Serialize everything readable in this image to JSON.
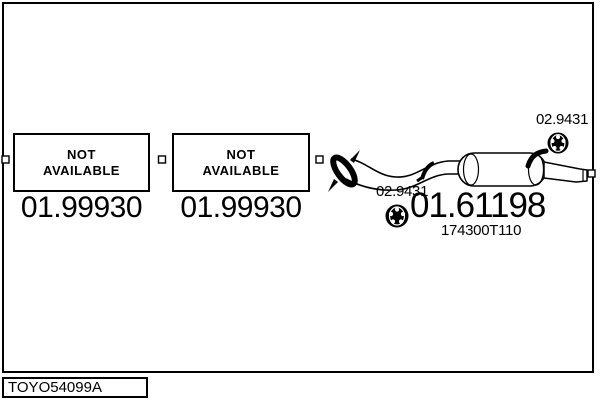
{
  "parts": {
    "placeholders": [
      {
        "label_line1": "NOT",
        "label_line2": "AVAILABLE",
        "part_number": "01.99930"
      },
      {
        "label_line1": "NOT",
        "label_line2": "AVAILABLE",
        "part_number": "01.99930"
      }
    ],
    "hangers": [
      {
        "part_number": "02.9431"
      },
      {
        "part_number": "02.9431"
      }
    ],
    "rear_silencer": {
      "part_number": "01.61198",
      "oem_reference": "174300T110"
    }
  },
  "footer": {
    "diagram_code": "TOYO54099A"
  },
  "icons": {
    "rubber_mount": "rubber-mount-ring",
    "connector": "connector-square-marker"
  },
  "colors": {
    "ink": "#000000",
    "background": "#ffffff"
  }
}
